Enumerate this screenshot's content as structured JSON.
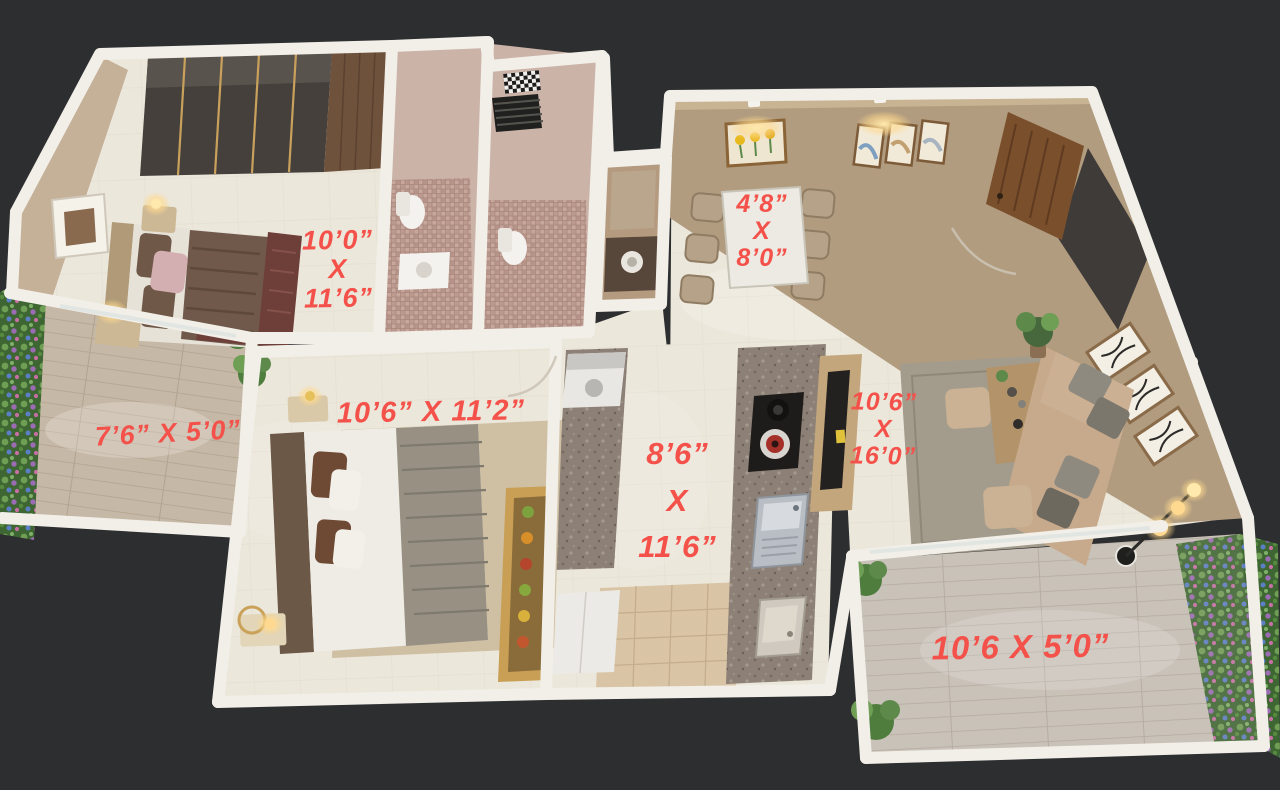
{
  "scene": {
    "kind": "3D rendered apartment floor plan (top-down isometric view)",
    "units": "feet and inches"
  },
  "colors": {
    "background": "#2d2e30",
    "dimension_label": "#f4514a",
    "floor_cream": "#ece7db",
    "wall_white": "#f2efe9",
    "wall_tan": "#b19c7f",
    "bathroom_mosaic": "#c7a79c",
    "deck_wood": "#c6b8a6",
    "kitchen_granite": "#8d8177",
    "plant_green": "#5d8a4a"
  },
  "rooms": {
    "master_bedroom": {
      "dimensions": [
        "10’0”",
        "X",
        "11’6”"
      ]
    },
    "dining": {
      "dimensions": [
        "4’8”",
        "X",
        "8’0”"
      ]
    },
    "balcony_left": {
      "dimensions": [
        "7’6” X 5’0”"
      ]
    },
    "bedroom_2": {
      "dimensions": [
        "10’6” X 11’2”"
      ]
    },
    "kitchen": {
      "dimensions": [
        "8’6”",
        "X",
        "11’6”"
      ]
    },
    "living_room": {
      "dimensions": [
        "10’6”",
        "X",
        "16’0”"
      ]
    },
    "balcony_right": {
      "dimensions": [
        "10’6 X 5’0”"
      ]
    }
  }
}
